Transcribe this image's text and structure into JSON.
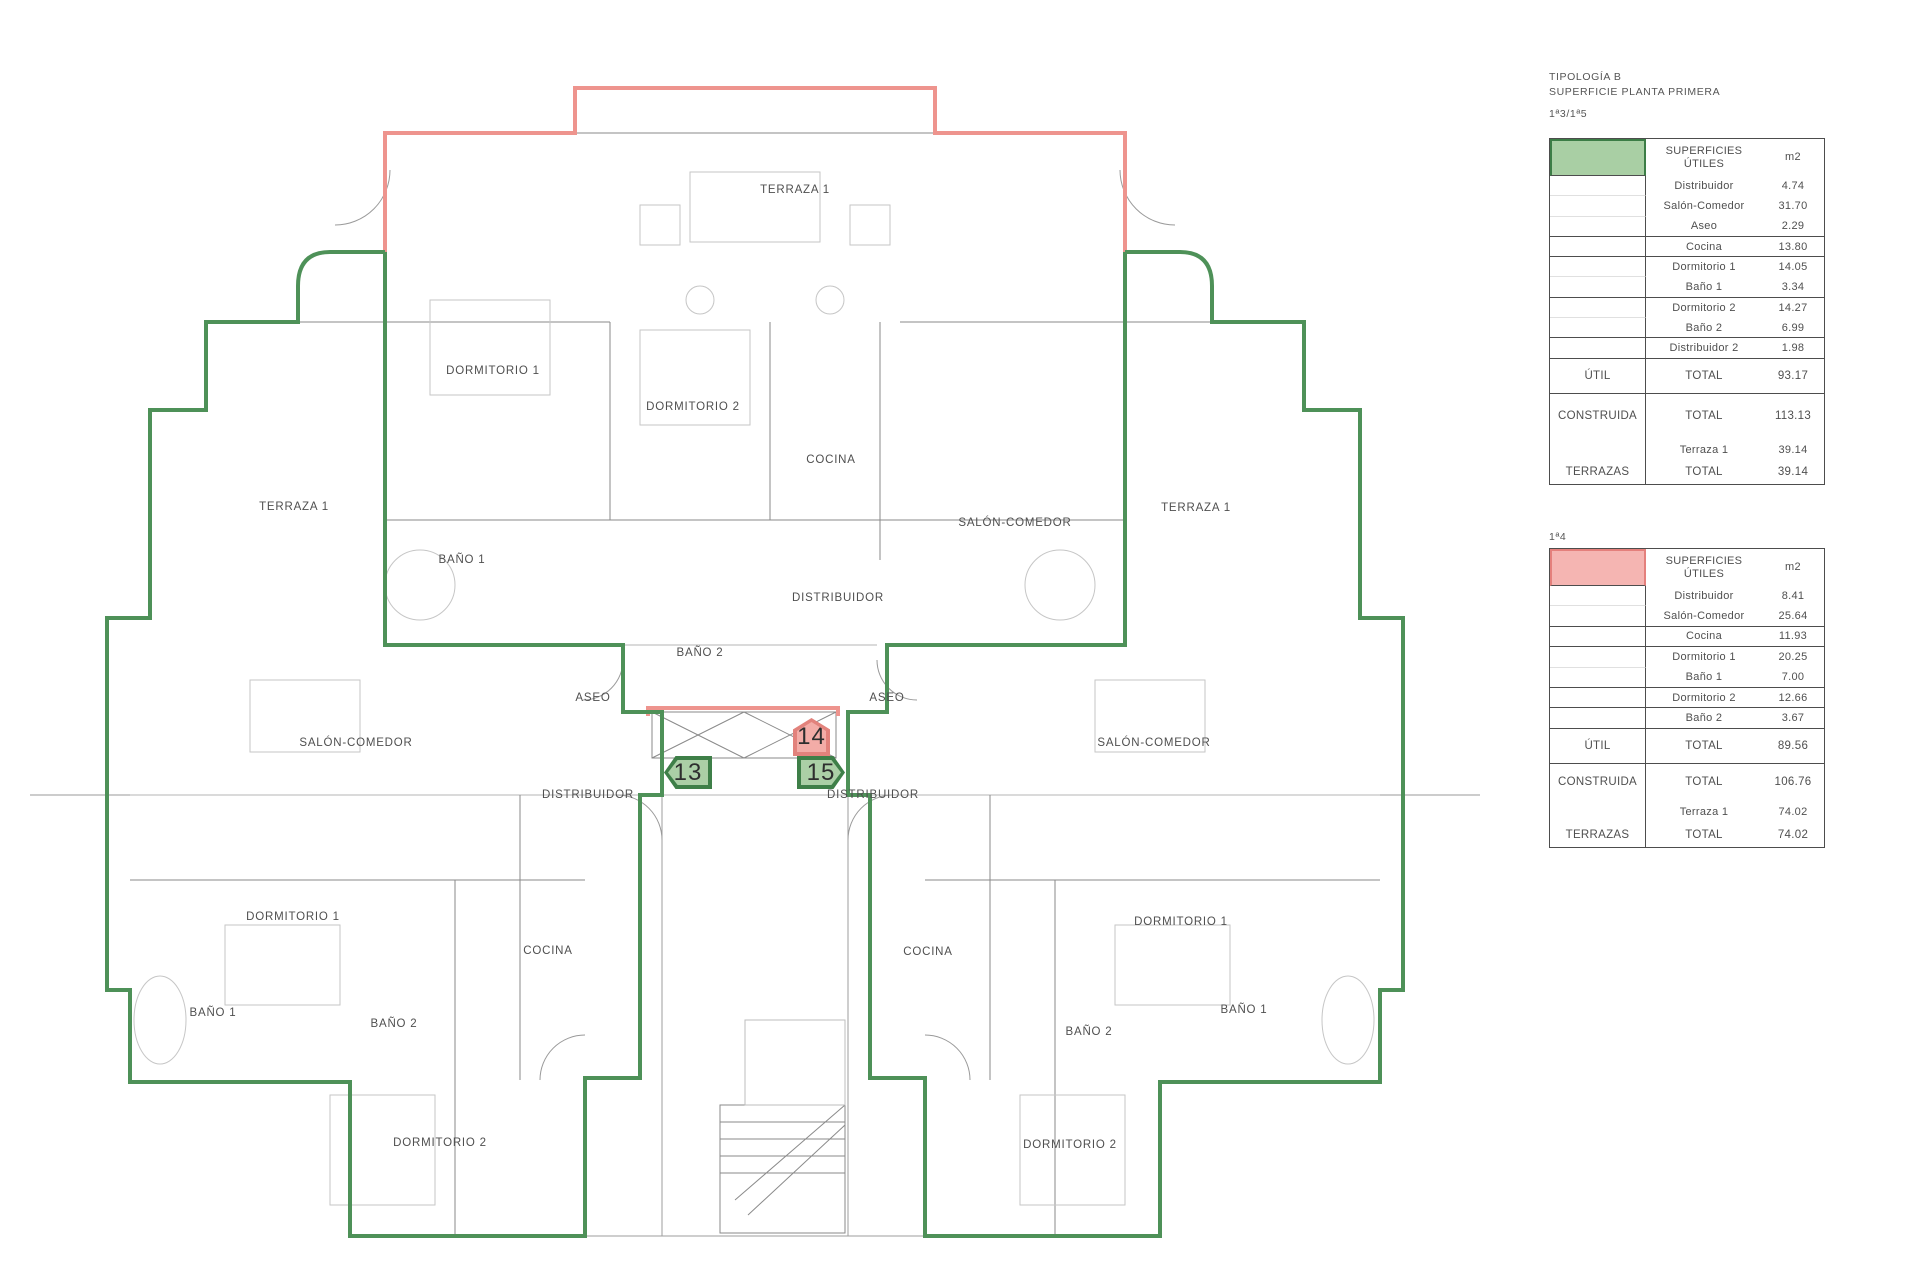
{
  "panel": {
    "title_line1": "TIPOLOGÍA B",
    "title_line2": "SUPERFICIE PLANTA PRIMERA",
    "accent_green": "#4e9158",
    "accent_pink": "#ee948e",
    "tables": [
      {
        "series_label": "1ª3/1ª5",
        "swatch_color": "#a9cfa4",
        "header": {
          "col2": "SUPERFICIES ÚTILES",
          "col3": "m2"
        },
        "rows": [
          {
            "c1": "",
            "c2": "Distribuidor",
            "c3": "4.74"
          },
          {
            "c1": "",
            "c2": "Salón-Comedor",
            "c3": "31.70"
          },
          {
            "c1": "",
            "c2": "Aseo",
            "c3": "2.29"
          },
          {
            "c1": "",
            "c2": "Cocina",
            "c3": "13.80"
          },
          {
            "c1": "",
            "c2": "Dormitorio 1",
            "c3": "14.05"
          },
          {
            "c1": "",
            "c2": "Baño 1",
            "c3": "3.34"
          },
          {
            "c1": "",
            "c2": "Dormitorio 2",
            "c3": "14.27"
          },
          {
            "c1": "",
            "c2": "Baño 2",
            "c3": "6.99"
          },
          {
            "c1": "",
            "c2": "Distribuidor 2",
            "c3": "1.98"
          },
          {
            "c1": "ÚTIL",
            "c2": "TOTAL",
            "c3": "93.17"
          },
          {
            "c1": "CONSTRUIDA",
            "c2": "TOTAL",
            "c3": "113.13"
          },
          {
            "c1": "",
            "c2": "Terraza 1",
            "c3": "39.14"
          },
          {
            "c1": "TERRAZAS",
            "c2": "TOTAL",
            "c3": "39.14"
          }
        ]
      },
      {
        "series_label": "1ª4",
        "swatch_color": "#f5b5b2",
        "header": {
          "col2": "SUPERFICIES ÚTILES",
          "col3": "m2"
        },
        "rows": [
          {
            "c1": "",
            "c2": "Distribuidor",
            "c3": "8.41"
          },
          {
            "c1": "",
            "c2": "Salón-Comedor",
            "c3": "25.64"
          },
          {
            "c1": "",
            "c2": "Cocina",
            "c3": "11.93"
          },
          {
            "c1": "",
            "c2": "Dormitorio 1",
            "c3": "20.25"
          },
          {
            "c1": "",
            "c2": "Baño 1",
            "c3": "7.00"
          },
          {
            "c1": "",
            "c2": "Dormitorio 2",
            "c3": "12.66"
          },
          {
            "c1": "",
            "c2": "Baño 2",
            "c3": "3.67"
          },
          {
            "c1": "ÚTIL",
            "c2": "TOTAL",
            "c3": "89.56"
          },
          {
            "c1": "CONSTRUIDA",
            "c2": "TOTAL",
            "c3": "106.76"
          },
          {
            "c1": "",
            "c2": "Terraza 1",
            "c3": "74.02"
          },
          {
            "c1": "TERRAZAS",
            "c2": "TOTAL",
            "c3": "74.02"
          }
        ]
      }
    ]
  },
  "plan": {
    "labels": [
      {
        "text": "TERRAZA 1"
      },
      {
        "text": "DORMITORIO 1"
      },
      {
        "text": "DORMITORIO 2"
      },
      {
        "text": "COCINA"
      },
      {
        "text": "SALÓN-COMEDOR"
      },
      {
        "text": "TERRAZA 1"
      },
      {
        "text": "TERRAZA 1"
      },
      {
        "text": "BAÑO 1"
      },
      {
        "text": "DISTRIBUIDOR"
      },
      {
        "text": "BAÑO 2"
      },
      {
        "text": "ASEO"
      },
      {
        "text": "ASEO"
      },
      {
        "text": "SALÓN-COMEDOR"
      },
      {
        "text": "SALÓN-COMEDOR"
      },
      {
        "text": "DISTRIBUIDOR"
      },
      {
        "text": "DISTRIBUIDOR"
      },
      {
        "text": "DORMITORIO 1"
      },
      {
        "text": "DORMITORIO 1"
      },
      {
        "text": "COCINA"
      },
      {
        "text": "COCINA"
      },
      {
        "text": "BAÑO 1"
      },
      {
        "text": "BAÑO 2"
      },
      {
        "text": "BAÑO 2"
      },
      {
        "text": "BAÑO 1"
      },
      {
        "text": "DORMITORIO 2"
      },
      {
        "text": "DORMITORIO 2"
      }
    ],
    "badges": [
      {
        "number": "13"
      },
      {
        "number": "14"
      },
      {
        "number": "15"
      }
    ]
  }
}
